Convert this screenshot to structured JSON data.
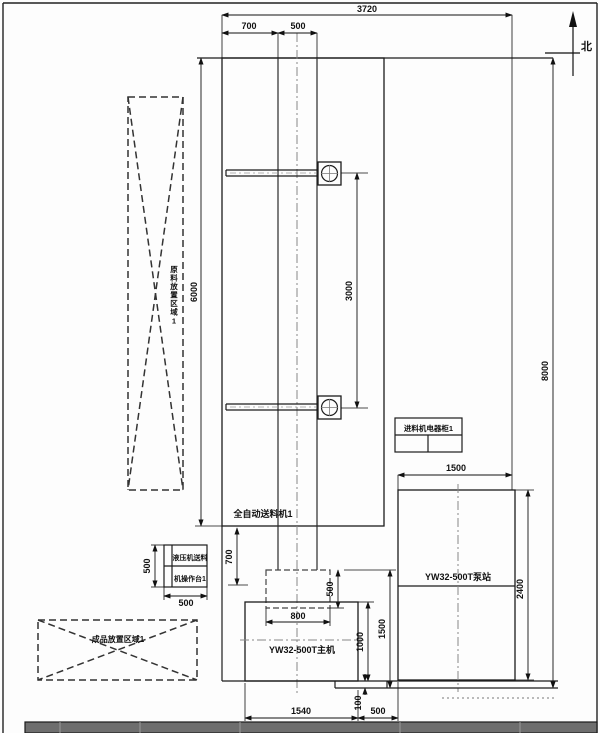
{
  "drawing": {
    "compass": {
      "north": "北"
    },
    "labels": {
      "raw_area": "原料放置区域1",
      "feeder": "全自动送料机1",
      "cabinet": "进料机电器柜1",
      "pump_station": "YW32-500T泵站",
      "main_press": "YW32-500T主机",
      "console_line1": "液压机送料",
      "console_line2": "机操作台1",
      "finished_area": "成品放置区域1"
    },
    "dims": {
      "overall_width": "3720",
      "offset_left": "700",
      "column_width": "500",
      "feeder_zone_height": "6000",
      "arm_spacing": "3000",
      "overall_height": "8000",
      "pump_width": "1500",
      "pump_depth": "2400",
      "press_offset": "700",
      "console_depth": "500",
      "console_width": "500",
      "slide_depth": "500",
      "slide_width": "800",
      "press_depth": "1000",
      "press_total_depth": "1500",
      "press_width": "1540",
      "press_pump_gap": "500",
      "base_step": "100"
    }
  }
}
